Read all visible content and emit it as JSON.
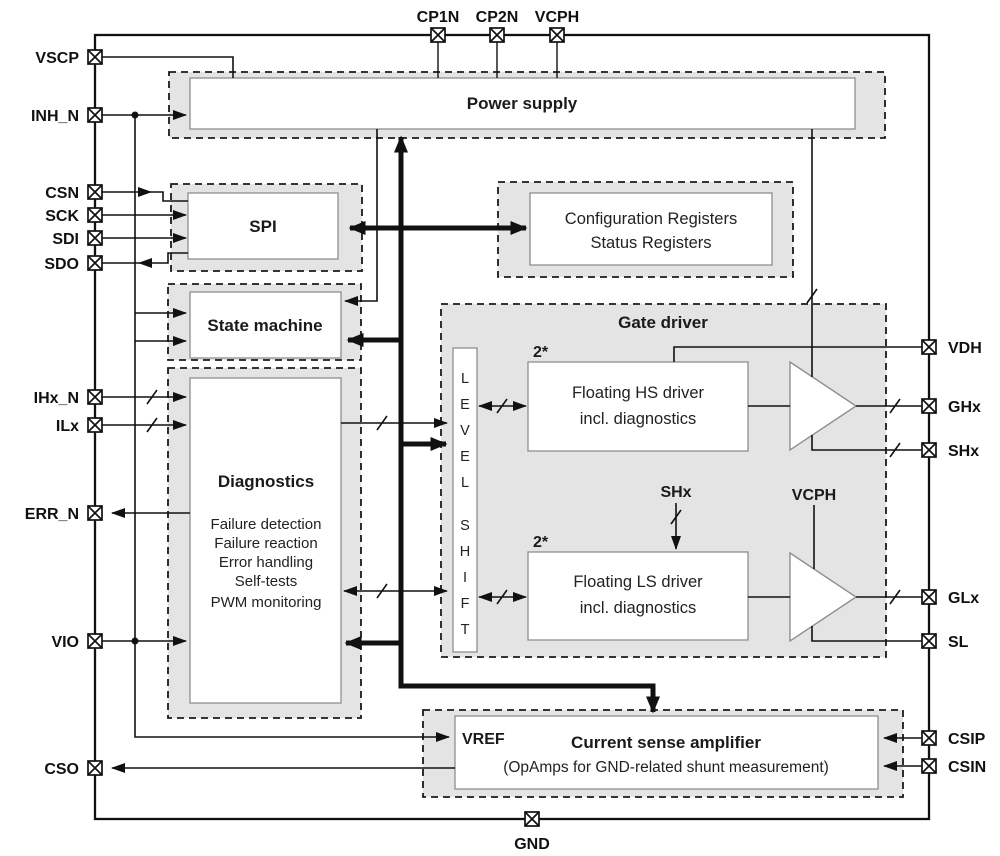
{
  "pins": {
    "top": [
      {
        "label": "CP1N"
      },
      {
        "label": "CP2N"
      },
      {
        "label": "VCPH"
      }
    ],
    "left": [
      {
        "label": "VSCP"
      },
      {
        "label": "INH_N"
      },
      {
        "label": "CSN"
      },
      {
        "label": "SCK"
      },
      {
        "label": "SDI"
      },
      {
        "label": "SDO"
      },
      {
        "label": "IHx_N"
      },
      {
        "label": "ILx"
      },
      {
        "label": "ERR_N"
      },
      {
        "label": "VIO"
      },
      {
        "label": "CSO"
      }
    ],
    "right": [
      {
        "label": "VDH"
      },
      {
        "label": "GHx"
      },
      {
        "label": "SHx"
      },
      {
        "label": "GLx"
      },
      {
        "label": "SL"
      },
      {
        "label": "CSIP"
      },
      {
        "label": "CSIN"
      }
    ],
    "bottom": [
      {
        "label": "GND"
      }
    ]
  },
  "blocks": {
    "power_supply": {
      "title": "Power supply"
    },
    "spi": {
      "title": "SPI"
    },
    "registers": {
      "line1": "Configuration Registers",
      "line2": "Status Registers"
    },
    "state_machine": {
      "title": "State machine"
    },
    "diagnostics": {
      "title": "Diagnostics",
      "items": [
        "Failure detection",
        "Failure reaction",
        "Error handling",
        "Self-tests",
        "PWM monitoring"
      ]
    },
    "gate_driver": {
      "title": "Gate driver",
      "level_shift_letters": [
        "L",
        "E",
        "V",
        "E",
        "L",
        "S",
        "H",
        "I",
        "F",
        "T"
      ],
      "hs": {
        "count": "2*",
        "line1": "Floating HS driver",
        "line2": "incl. diagnostics"
      },
      "ls": {
        "count": "2*",
        "line1": "Floating LS driver",
        "line2": "incl. diagnostics"
      },
      "shx_net": "SHx",
      "vcph_net": "VCPH"
    },
    "csa": {
      "vref": "VREF",
      "title": "Current sense amplifier",
      "subtitle": "(OpAmps for GND-related shunt measurement)"
    }
  },
  "colors": {
    "line": "#111111",
    "block_fill": "#e4e4e4",
    "inner_box_border": "#8f8f8f",
    "background": "#ffffff"
  }
}
